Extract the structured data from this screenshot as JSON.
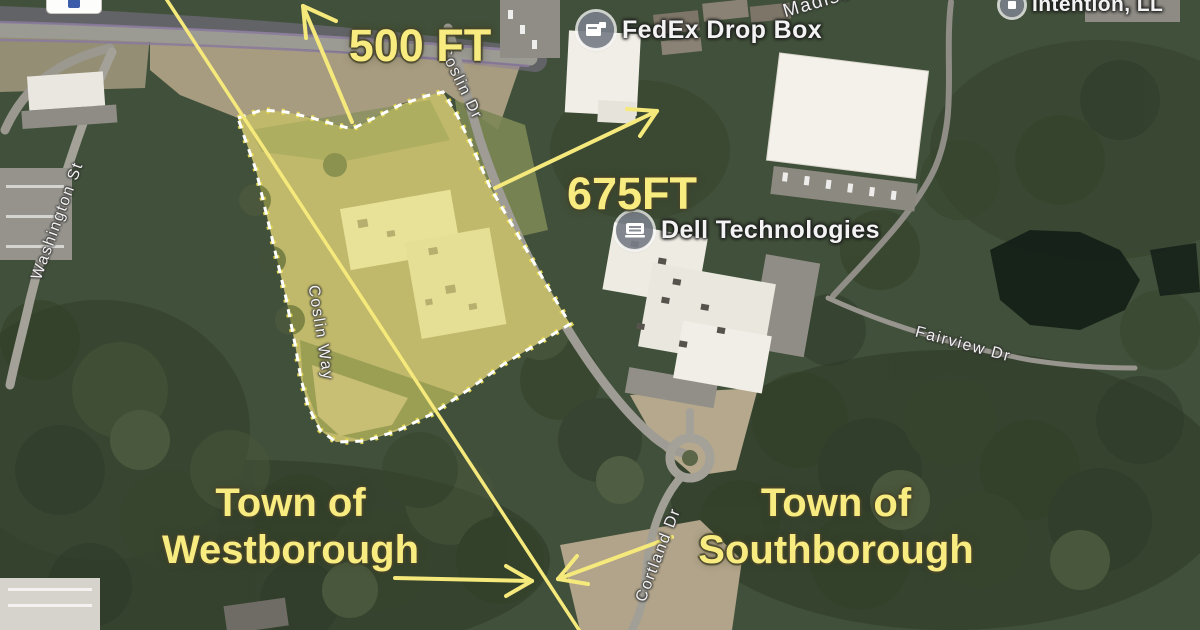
{
  "map": {
    "annotations": {
      "dist_500": "500 FT",
      "dist_675": "675FT",
      "westborough": {
        "line1": "Town of",
        "line2": "Westborough"
      },
      "southborough": {
        "line1": "Town of",
        "line2": "Southborough"
      }
    },
    "pois": {
      "fedex": "FedEx Drop Box",
      "dell": "Dell Technologies",
      "intention": "Intention, LL",
      "madison": "Madison"
    },
    "streets": {
      "washington": "Washington St",
      "coslin_dr": "Coslin Dr",
      "coslin_way": "Coslin Way",
      "fairview": "Fairview Dr",
      "cortland": "Cortland Dr"
    },
    "colors": {
      "annotation_yellow": "#F8EC80",
      "boundary_line": "#F6E97C",
      "parcel_fill": "rgba(240,232,90,0.32)",
      "parcel_dash": "#FFFFFF",
      "forest_base": "#41503A",
      "label_white": "#FFFFFF"
    }
  }
}
